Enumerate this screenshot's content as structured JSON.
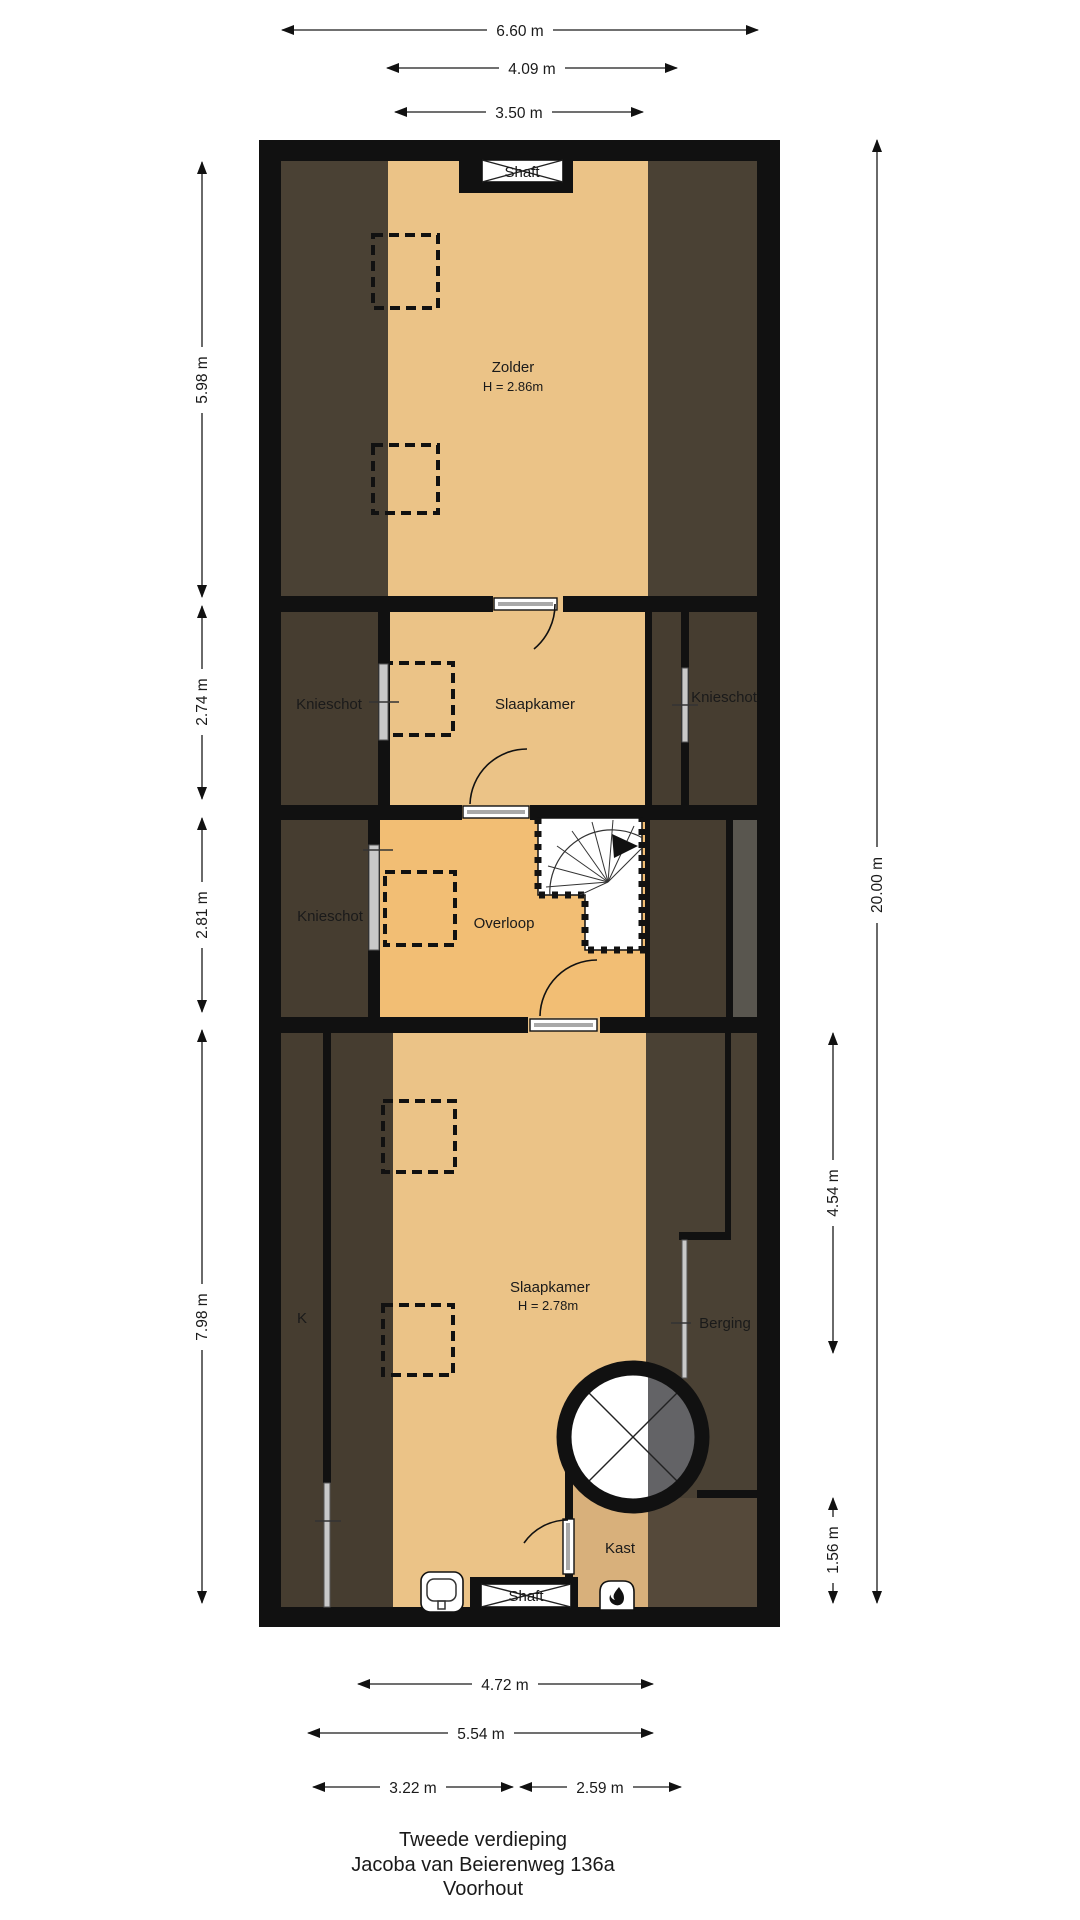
{
  "title": {
    "floor": "Tweede verdieping",
    "address": "Jacoba van Beierenweg 136a",
    "city": "Voorhout"
  },
  "rooms": {
    "zolder": "Zolder",
    "zolder_height": "H = 2.86m",
    "slaapkamer_top": "Slaapkamer",
    "knieschot_left_top": "Knieschot",
    "knieschot_right": "Knieschot",
    "knieschot_left_mid": "Knieschot",
    "overloop": "Overloop",
    "slaapkamer_bottom": "Slaapkamer",
    "slaapkamer_bottom_height": "H = 2.78m",
    "k": "K",
    "berging": "Berging",
    "kast": "Kast"
  },
  "shafts": {
    "top": "Shaft",
    "bottom": "Shaft"
  },
  "dimensions": {
    "top_660": "6.60 m",
    "top_409": "4.09 m",
    "top_350": "3.50 m",
    "bottom_472": "4.72 m",
    "bottom_554": "5.54 m",
    "bottom_322": "3.22 m",
    "bottom_259": "2.59 m",
    "left_598": "5.98 m",
    "left_274": "2.74 m",
    "left_281": "2.81 m",
    "left_798": "7.98 m",
    "right_2000": "20.00 m",
    "right_454": "4.54 m",
    "right_156": "1.56 m"
  },
  "colors": {
    "wall": "#111111",
    "floor": "#ebc387",
    "floor_landing": "#f2be74",
    "floor_closet": "#d8b07b",
    "roof_slope_dark": "#4a4134",
    "roof_slope_darker": "#463d30",
    "void_gray": "#636366",
    "strip_gray": "#59564f"
  }
}
